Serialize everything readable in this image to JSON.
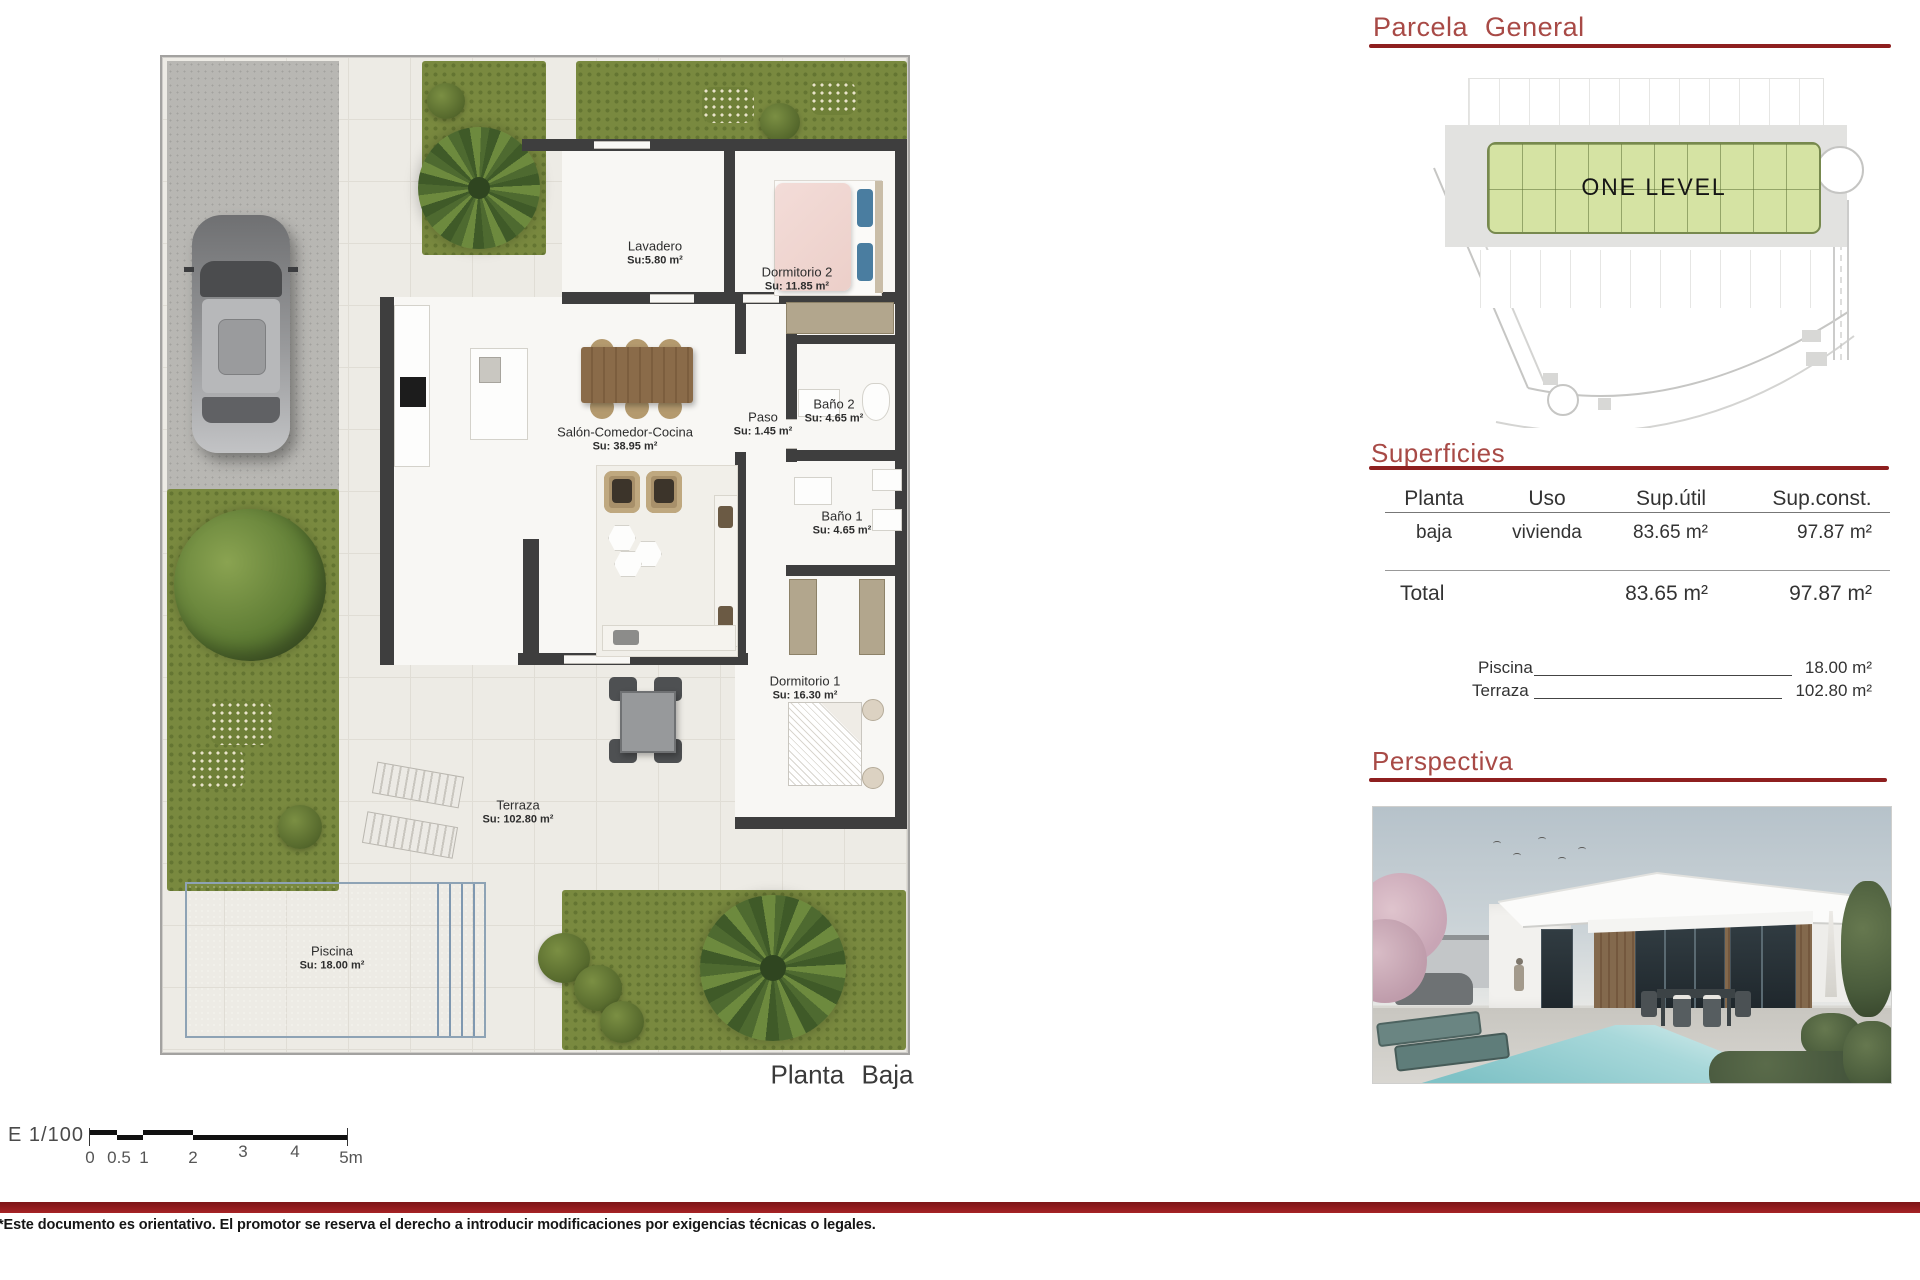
{
  "plan": {
    "caption": "Planta Baja",
    "rooms": [
      {
        "name": "Lavadero",
        "su": "Su:5.80 m²"
      },
      {
        "name": "Dormitorio 2",
        "su": "Su: 11.85 m²"
      },
      {
        "name": "Baño 2",
        "su": "Su: 4.65 m²"
      },
      {
        "name": "Paso",
        "su": "Su: 1.45 m²"
      },
      {
        "name": "Salón-Comedor-Cocina",
        "su": "Su: 38.95 m²"
      },
      {
        "name": "Baño 1",
        "su": "Su: 4.65 m²"
      },
      {
        "name": "Dormitorio 1",
        "su": "Su: 16.30 m²"
      },
      {
        "name": "Terraza",
        "su": "Su: 102.80 m²"
      },
      {
        "name": "Piscina",
        "su": "Su: 18.00 m²"
      }
    ],
    "scale": {
      "label": "E 1/100",
      "ticks": [
        "0",
        "0.5",
        "1",
        "2",
        "3",
        "4",
        "5m"
      ]
    }
  },
  "parcela": {
    "title": "Parcela General",
    "block_label": "ONE LEVEL"
  },
  "superficies": {
    "title": "Superficies",
    "headers": [
      "Planta",
      "Uso",
      "Sup.útil",
      "Sup.const."
    ],
    "rows": [
      [
        "baja",
        "vivienda",
        "83.65 m²",
        "97.87 m²"
      ]
    ],
    "total_label": "Total",
    "total_util": "83.65 m²",
    "total_const": "97.87 m²",
    "extras": [
      {
        "label": "Piscina",
        "value": "18.00 m²"
      },
      {
        "label": "Terraza",
        "value": "102.80 m²"
      }
    ]
  },
  "perspectiva": {
    "title": "Perspectiva"
  },
  "footer": {
    "disclaimer": "*Este documento es orientativo. El promotor se reserva el derecho a introducir modificaciones por exigencias técnicas o legales."
  },
  "colors": {
    "accent_red": "#a84a46",
    "rule_red": "#8e1f1f",
    "wall_gray": "#3e3e3e",
    "grass_green": "#79893f",
    "pool_blue": "#a9bfd3",
    "green_block": "#d5e3a3"
  }
}
